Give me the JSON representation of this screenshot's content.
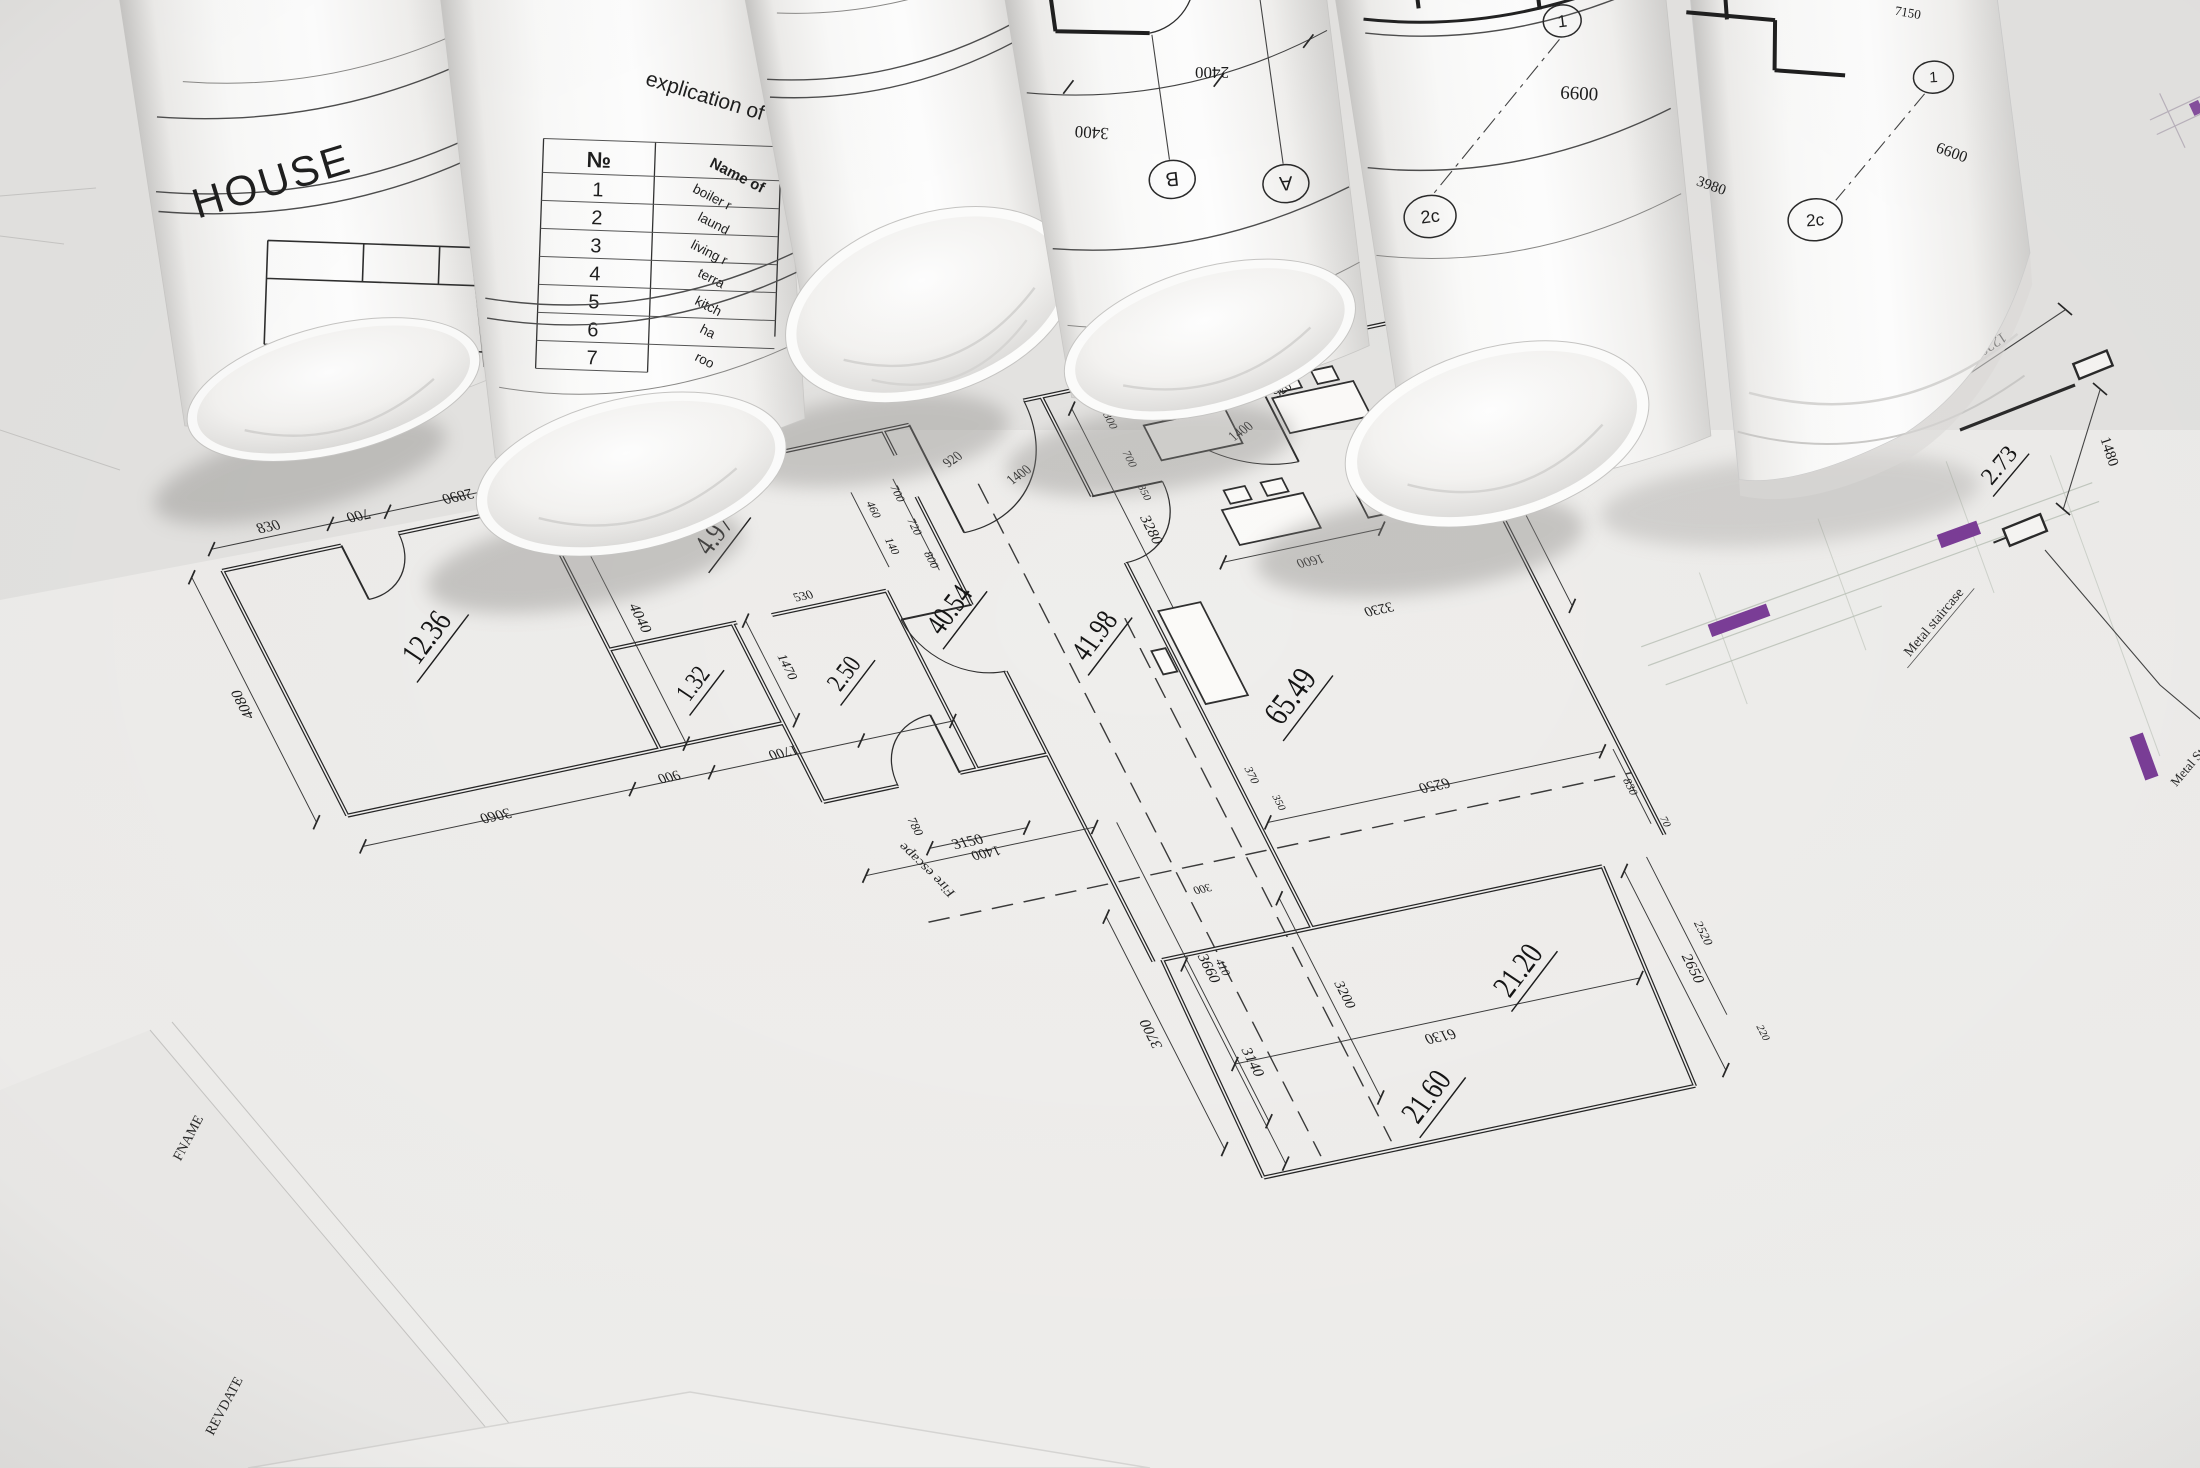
{
  "rolls": {
    "house_label": "HOUSE",
    "explication_title": "explication of",
    "table": {
      "header_no": "№",
      "header_name": "Name of",
      "rows": [
        "1",
        "2",
        "3",
        "4",
        "5",
        "6",
        "7"
      ],
      "names": [
        "boiler r",
        "laund",
        "living r",
        "terra",
        "kitch",
        "ha",
        "roo"
      ]
    },
    "axis_letters": {
      "b": "B",
      "a": "A",
      "one": "1",
      "two_c": "2c"
    },
    "dims": {
      "d2400": "2400",
      "d3400": "3400",
      "d6600": "6600",
      "d7150": "7150",
      "d3980": "3980"
    }
  },
  "stair_detail": {
    "d1220": "1220",
    "d1480": "1480",
    "area": "2.73",
    "label_staircase": "Metal staircase",
    "label_glass_1": "Metal Stained Glass",
    "label_glass_2": "with door"
  },
  "sheet_corner": {
    "fname": "FNAME",
    "revdate": "REVDATE"
  },
  "plan": {
    "areas": {
      "a1236": "12.36",
      "a497": "4.97",
      "a132": "1.32",
      "a250": "2.50",
      "a4054": "40.54",
      "a4198": "41.98",
      "a6549": "65.49",
      "a2120": "21.20",
      "a2160": "21.60"
    },
    "labels": {
      "fire_escape": "Fire escape"
    },
    "dims": {
      "d4080": "4080",
      "d4040": "4040",
      "d830": "830",
      "d700": "700",
      "d2890": "2890",
      "d3060": "3060",
      "d900": "900",
      "d1700": "1700",
      "d780": "780",
      "d1400": "1400",
      "d1470": "1470",
      "d530": "530",
      "d140": "140",
      "d460": "460",
      "d720": "720",
      "d800": "800",
      "d920": "920",
      "d3280": "3280",
      "d3150": "3150",
      "d3660": "3660",
      "d370": "370",
      "d300": "300",
      "d6250": "6250",
      "d350": "350",
      "d1600": "1600",
      "d3230": "3230",
      "d1050": "1050",
      "d2560": "2560",
      "d70": "70",
      "d3200": "3200",
      "d3700": "3700",
      "d3140": "3140",
      "d410": "410",
      "d6130": "6130",
      "d2650": "2650",
      "d2520": "2520",
      "d220": "220"
    }
  },
  "colors": {
    "accent_purple": "#6f2b8e",
    "ink": "#2b2b2b",
    "paper": "#f1f0ee",
    "table_surface": "#e6e5e3"
  }
}
